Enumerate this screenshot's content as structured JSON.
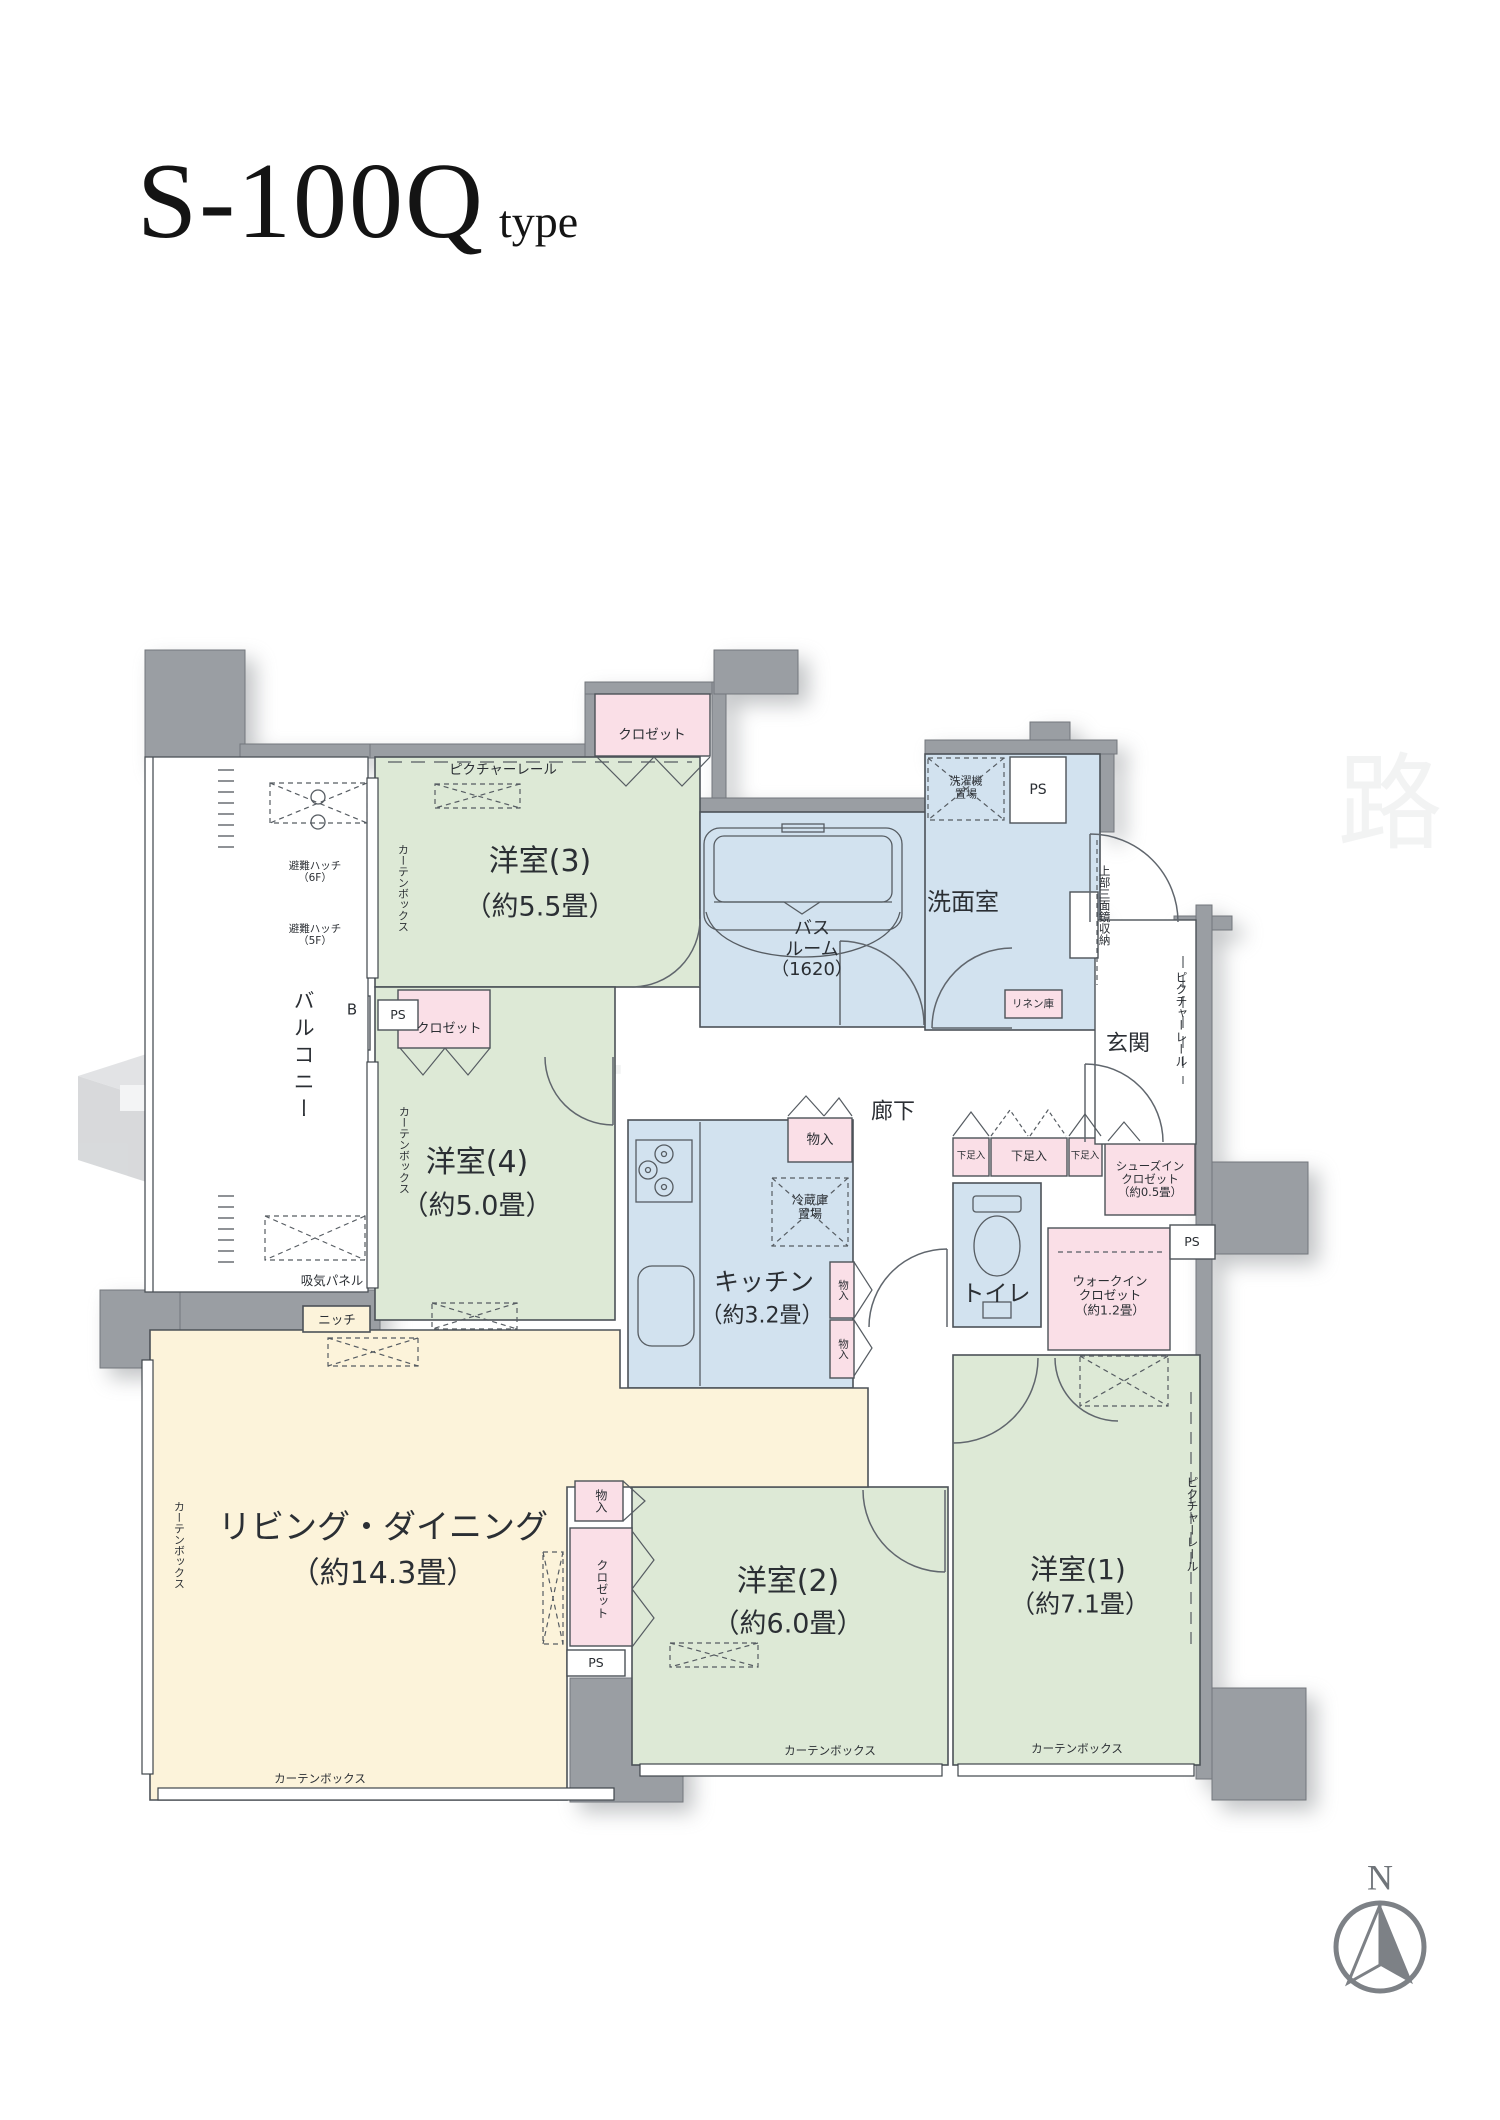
{
  "title": {
    "main": "S-100Q",
    "suffix": "type"
  },
  "compass": {
    "label": "N"
  },
  "watermark": {
    "text_left": "中古",
    "text_right": "路"
  },
  "rooms": {
    "yoshitsu3": {
      "name": "洋室(3)",
      "size": "（約5.5畳）"
    },
    "yoshitsu4": {
      "name": "洋室(4)",
      "size": "（約5.0畳）"
    },
    "yoshitsu2": {
      "name": "洋室(2)",
      "size": "（約6.0畳）"
    },
    "yoshitsu1": {
      "name": "洋室(1)",
      "size": "（約7.1畳）"
    },
    "living": {
      "name": "リビング・ダイニング",
      "size": "（約14.3畳）"
    },
    "kitchen": {
      "name": "キッチン",
      "size": "（約3.2畳）"
    },
    "bath": {
      "l1": "バス",
      "l2": "ルーム",
      "l3": "（1620）"
    },
    "wash": {
      "name": "洗面室"
    },
    "toilet": {
      "name": "トイレ"
    },
    "genkan": {
      "name": "玄関"
    },
    "hallway": {
      "name": "廊下"
    },
    "balcony": {
      "name": "バルコニー"
    }
  },
  "storage": {
    "closet": "クロゼット",
    "monoire": "物入",
    "getabako": "下足入",
    "linen": "リネン庫",
    "niche": "ニッチ",
    "sic": {
      "l1": "シューズイン",
      "l2": "クロゼット",
      "l3": "（約0.5畳）"
    },
    "wic": {
      "l1": "ウォークイン",
      "l2": "クロゼット",
      "l3": "（約1.2畳）"
    },
    "washer": {
      "l1": "洗濯機",
      "l2": "置場"
    },
    "fridge": {
      "l1": "冷蔵庫",
      "l2": "置場"
    }
  },
  "annotations": {
    "picture_rail": "ピクチャーレール",
    "curtain_box": "カーテンボックス",
    "hatch6": {
      "l1": "避難ハッチ",
      "l2": "（6F）"
    },
    "hatch5": {
      "l1": "避難ハッチ",
      "l2": "（5F）"
    },
    "intake": "吸気パネル",
    "mirror": "上部三面鏡収納",
    "ps": "PS",
    "b": "B"
  },
  "colors": {
    "room_green": "#dde9d6",
    "room_blue": "#d2e2ef",
    "room_pink": "#fadfe7",
    "room_cream": "#fcf3da",
    "wall_gray": "#9a9ea3",
    "line": "#4c5258",
    "compass_gray": "#7d8186"
  }
}
